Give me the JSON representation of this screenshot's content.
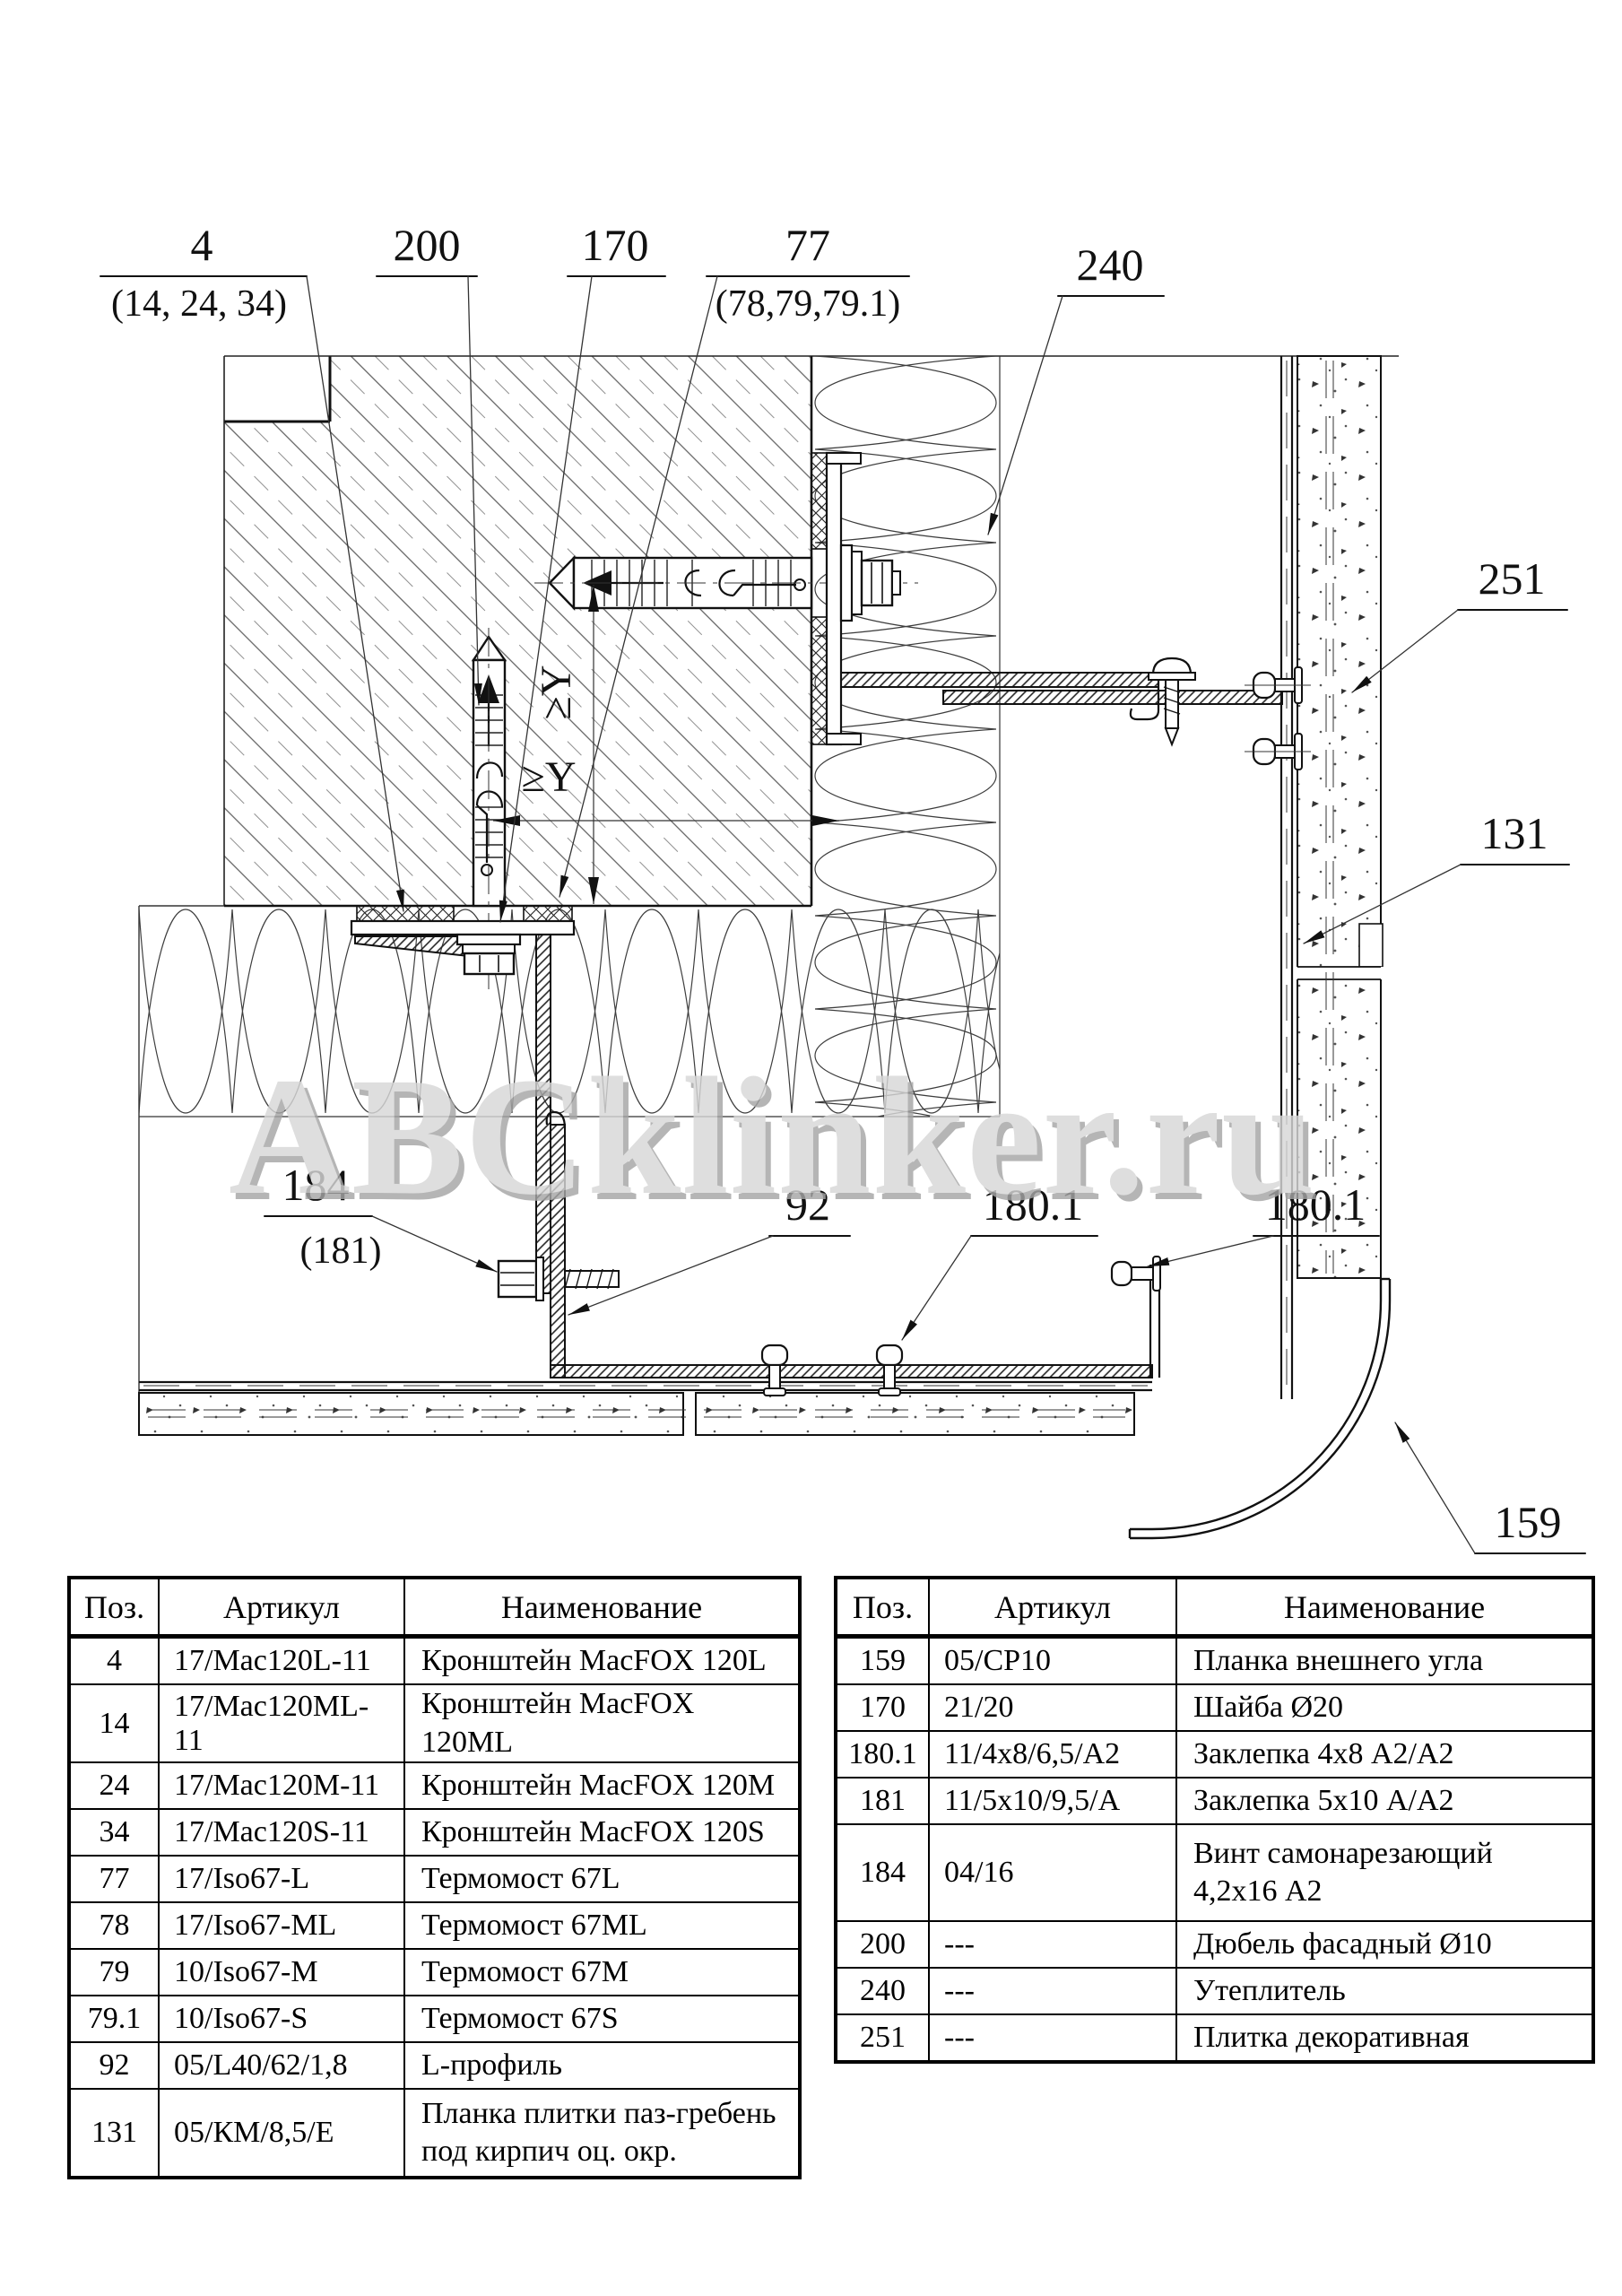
{
  "watermark": "ABCklinker.ru",
  "drawing": {
    "title_semantic": "facade external corner fixing detail",
    "dimensions": {
      "vertical": "≥Y",
      "horizontal": "≥Y"
    },
    "callouts": [
      {
        "text": "4",
        "sub": "(14, 24, 34)"
      },
      {
        "text": "200",
        "sub": ""
      },
      {
        "text": "170",
        "sub": ""
      },
      {
        "text": "77",
        "sub": "(78,79,79.1)"
      },
      {
        "text": "240",
        "sub": ""
      },
      {
        "text": "251",
        "sub": ""
      },
      {
        "text": "131",
        "sub": ""
      },
      {
        "text": "184",
        "sub": "(181)"
      },
      {
        "text": "92",
        "sub": ""
      },
      {
        "text": "180.1",
        "sub": ""
      },
      {
        "text": "180.1",
        "sub": ""
      },
      {
        "text": "159",
        "sub": ""
      }
    ]
  },
  "tables": {
    "left": {
      "headers": [
        "Поз.",
        "Артикул",
        "Наименование"
      ],
      "rows": [
        [
          "4",
          "17/Mac120L-11",
          "Кронштейн MacFOX 120L"
        ],
        [
          "14",
          "17/Mac120ML-11",
          "Кронштейн MacFOX 120ML"
        ],
        [
          "24",
          "17/Mac120M-11",
          "Кронштейн MacFOX 120M"
        ],
        [
          "34",
          "17/Mac120S-11",
          "Кронштейн MacFOX 120S"
        ],
        [
          "77",
          "17/Iso67-L",
          "Термомост 67L"
        ],
        [
          "78",
          "17/Iso67-ML",
          "Термомост 67ML"
        ],
        [
          "79",
          "10/Iso67-M",
          "Термомост 67M"
        ],
        [
          "79.1",
          "10/Iso67-S",
          "Термомост 67S"
        ],
        [
          "92",
          "05/L40/62/1,8",
          "L-профиль"
        ],
        [
          "131",
          "05/КМ/8,5/Е",
          "Планка плитки паз-гребень под кирпич оц. окр."
        ]
      ]
    },
    "right": {
      "headers": [
        "Поз.",
        "Артикул",
        "Наименование"
      ],
      "rows": [
        [
          "159",
          "05/СР10",
          "Планка внешнего угла"
        ],
        [
          "170",
          "21/20",
          "Шайба Ø20"
        ],
        [
          "180.1",
          "11/4x8/6,5/А2",
          "Заклепка 4x8 А2/А2"
        ],
        [
          "181",
          "11/5x10/9,5/А",
          "Заклепка 5x10 А/А2"
        ],
        [
          "184",
          "04/16",
          "Винт самонарезающий 4,2x16 А2"
        ],
        [
          "200",
          "---",
          "Дюбель фасадный Ø10"
        ],
        [
          "240",
          "---",
          "Утеплитель"
        ],
        [
          "251",
          "---",
          "Плитка декоративная"
        ]
      ]
    }
  }
}
